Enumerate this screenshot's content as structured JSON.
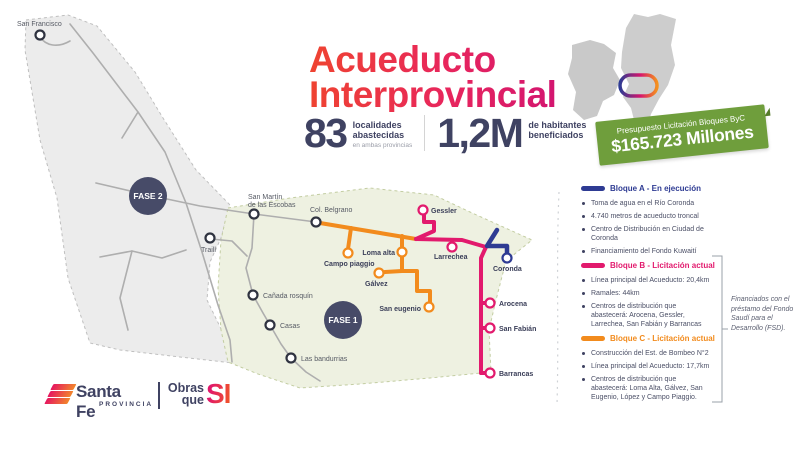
{
  "header": {
    "title_line1": "Acueducto",
    "title_line2": "Interprovincial",
    "stat1": {
      "value": "83",
      "label_line1": "localidades",
      "label_line2": "abastecidas",
      "sublabel": "en ambas provincias"
    },
    "stat2": {
      "value": "1,2M",
      "label_line1": "de habitantes",
      "label_line2": "beneficiados"
    }
  },
  "budget_banner": {
    "line1": "Presupuesto Licitación Bloques ByC",
    "line2": "$165.723 Millones"
  },
  "legend": {
    "blocks": [
      {
        "title": "Bloque A - En ejecución",
        "color": "#2e3b93",
        "items": [
          "Toma de agua en el Río Coronda",
          "4.740 metros de acueducto troncal",
          "Centro de Distribución en Ciudad de Coronda",
          "Financiamiento del Fondo Kuwaití"
        ]
      },
      {
        "title": "Bloque B - Licitación actual",
        "color": "#e21a6d",
        "items": [
          "Línea principal del Acueducto: 20,4km",
          "Ramales: 44km",
          "Centros de distribución que abastecerá: Arocena, Gessler, Larrechea, San Fabián y Barrancas"
        ]
      },
      {
        "title": "Bloque C - Licitación actual",
        "color": "#f28b1d",
        "items": [
          "Construcción del Est. de Bombeo N°2",
          "Línea principal del Acueducto: 17,7km",
          "Centros de distribución que abastecerá: Loma Alta, Gálvez, San Eugenio, López y Campo Piaggio."
        ]
      }
    ],
    "side_note": "Financiados con el préstamo del Fondo Saudí para el Desarrollo (FSD)."
  },
  "map": {
    "fase1": "FASE 1",
    "fase2": "FASE 2",
    "towns": {
      "san_francisco": "San Francisco",
      "san_martin_l1": "San Martín",
      "san_martin_l2": "de las Escobas",
      "traill": "Traill",
      "col_belgrano": "Col. Belgrano",
      "canada_rosquin": "Cañada rosquín",
      "casas": "Casas",
      "las_bandurrias": "Las bandurrias",
      "campo_piaggio": "Campo piaggio",
      "loma_alta": "Loma alta",
      "galvez": "Gálvez",
      "san_eugenio": "San eugenio",
      "gessler": "Gessler",
      "larrechea": "Larrechea",
      "coronda": "Coronda",
      "arocena": "Arocena",
      "san_fabian": "San Fabián",
      "barrancas": "Barrancas"
    }
  },
  "footer": {
    "brand": "Santa Fe",
    "brand_sub": "PROVINCIA",
    "slogan_line1": "Obras",
    "slogan_line2": "que",
    "slogan_accent": "SI"
  },
  "colors": {
    "bloque_a_blue": "#2e3b93",
    "bloque_b_pink": "#e21a6d",
    "bloque_c_orange": "#f28b1d",
    "budget_green": "#6f9e3c",
    "badge_navy": "#474b68",
    "fase1_region_fill": "#eef1e1",
    "fase2_region_fill": "#ececec",
    "title_gradient_start": "#ef4430",
    "title_gradient_end": "#d31570"
  }
}
